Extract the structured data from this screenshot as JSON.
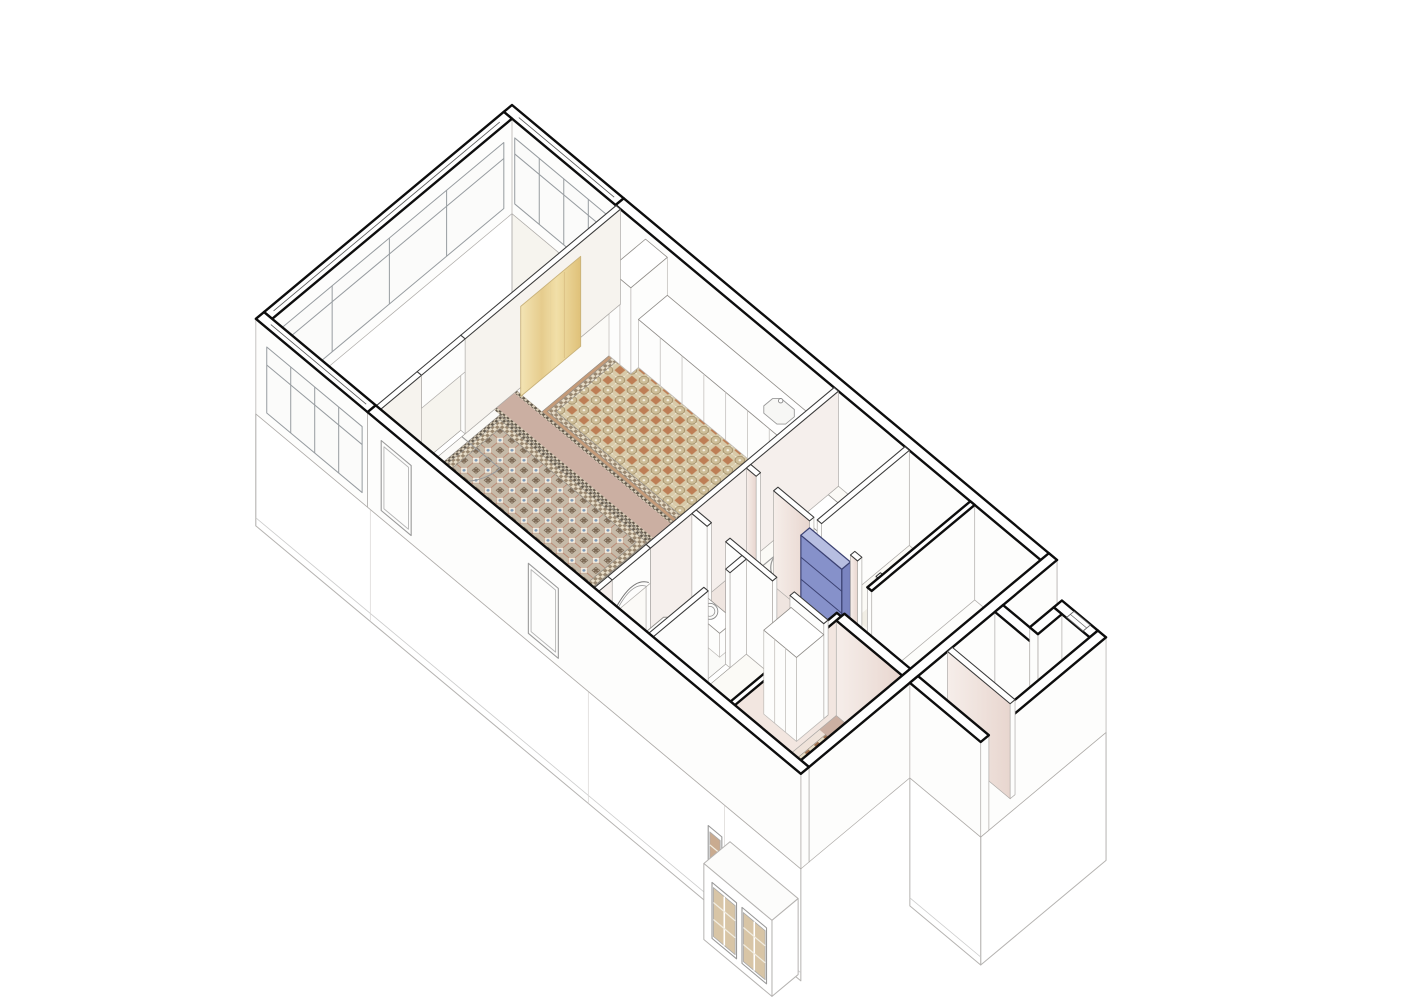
{
  "drawing": {
    "type": "axonometric-cutaway-apartment-floor-plan",
    "accent_color": "#8691ca",
    "palette": {
      "background": "#ffffff",
      "wall_top": "#ffffff",
      "outline_exterior": "#0d0d0d",
      "outline_interior": "#3a3a3a",
      "outline_furniture": "#8f8c88",
      "side_face": "#fdfdfc",
      "side_stroke": "#aeaba8",
      "facade_stroke": "#b5b3b1",
      "terrace_floor": "#f6f4ee",
      "living_floor": "#fbfaf7",
      "corridor_floor": "#efe5e0",
      "bedroom_floor": "#fbfaf6",
      "patch_floor": "#f1eee5",
      "bath_floor": "#fafaf8",
      "kitchen_floor_base": "#efe3da",
      "walkway_band": "#cbafa2",
      "rug1_bg": "#c6baa8",
      "rug1_blue": "#7e98b4",
      "rug1_red": "#b5765f",
      "rug1_dark": "#7d6a56",
      "rug2_bg": "#d8caa9",
      "rug2_terracotta": "#bd7e55",
      "border_checker_light": "#e6dcc8",
      "border_checker_dark": "#98866f",
      "kitchen_tile_a": "#c1794e",
      "kitchen_tile_b": "#9c6f4e",
      "annex_tile": "#d3c29c",
      "curtain_light": "#f3e4b4",
      "curtain_deep": "#dfc179",
      "curtain_edge": "#c9b27a",
      "accent_front": "#8691ca",
      "accent_side": "#7a84c0",
      "accent_top": "#b7bee1",
      "accent_outline": "#3c4273",
      "glass": "#fbfbfa",
      "glazing_stroke": "#979ca0",
      "window_glass_warm": "#d8c5a6",
      "window_glass_deep": "#c9ab90",
      "window_bar": "#f1ece0",
      "pink_wall_light": "#f6eeea",
      "pink_wall_deep": "#e8d6cf",
      "arc_stroke": "#9a9a9a"
    },
    "rooms": [
      {
        "id": "terrace-gallery",
        "floor": "plain"
      },
      {
        "id": "living-room",
        "floor": "tile-rugs"
      },
      {
        "id": "kitchen-nook",
        "floor": "rosette-tile"
      },
      {
        "id": "corridor",
        "floor": "pink"
      },
      {
        "id": "bathroom",
        "floor": "plain"
      },
      {
        "id": "bedroom-1",
        "floor": "plain"
      },
      {
        "id": "bedroom-2",
        "floor": "plain"
      },
      {
        "id": "rear-room",
        "floor": "plain"
      },
      {
        "id": "rear-kitchen",
        "floor": "checker-tile"
      },
      {
        "id": "lightwell",
        "floor": "open"
      },
      {
        "id": "annex-hall",
        "floor": "pale"
      },
      {
        "id": "annex-bathroom",
        "floor": "beige-tile"
      }
    ],
    "features": [
      "glazed-gallery-windows",
      "tile-rug-blue-diamond",
      "tile-rug-rosette",
      "walkway-band",
      "cream-curtain",
      "kitchen-counter",
      "blue-shelving-unit",
      "bathtub",
      "washbasin",
      "door-swing-arcs",
      "arched-doorway",
      "facade-casement-windows",
      "lightwell-notch"
    ]
  }
}
